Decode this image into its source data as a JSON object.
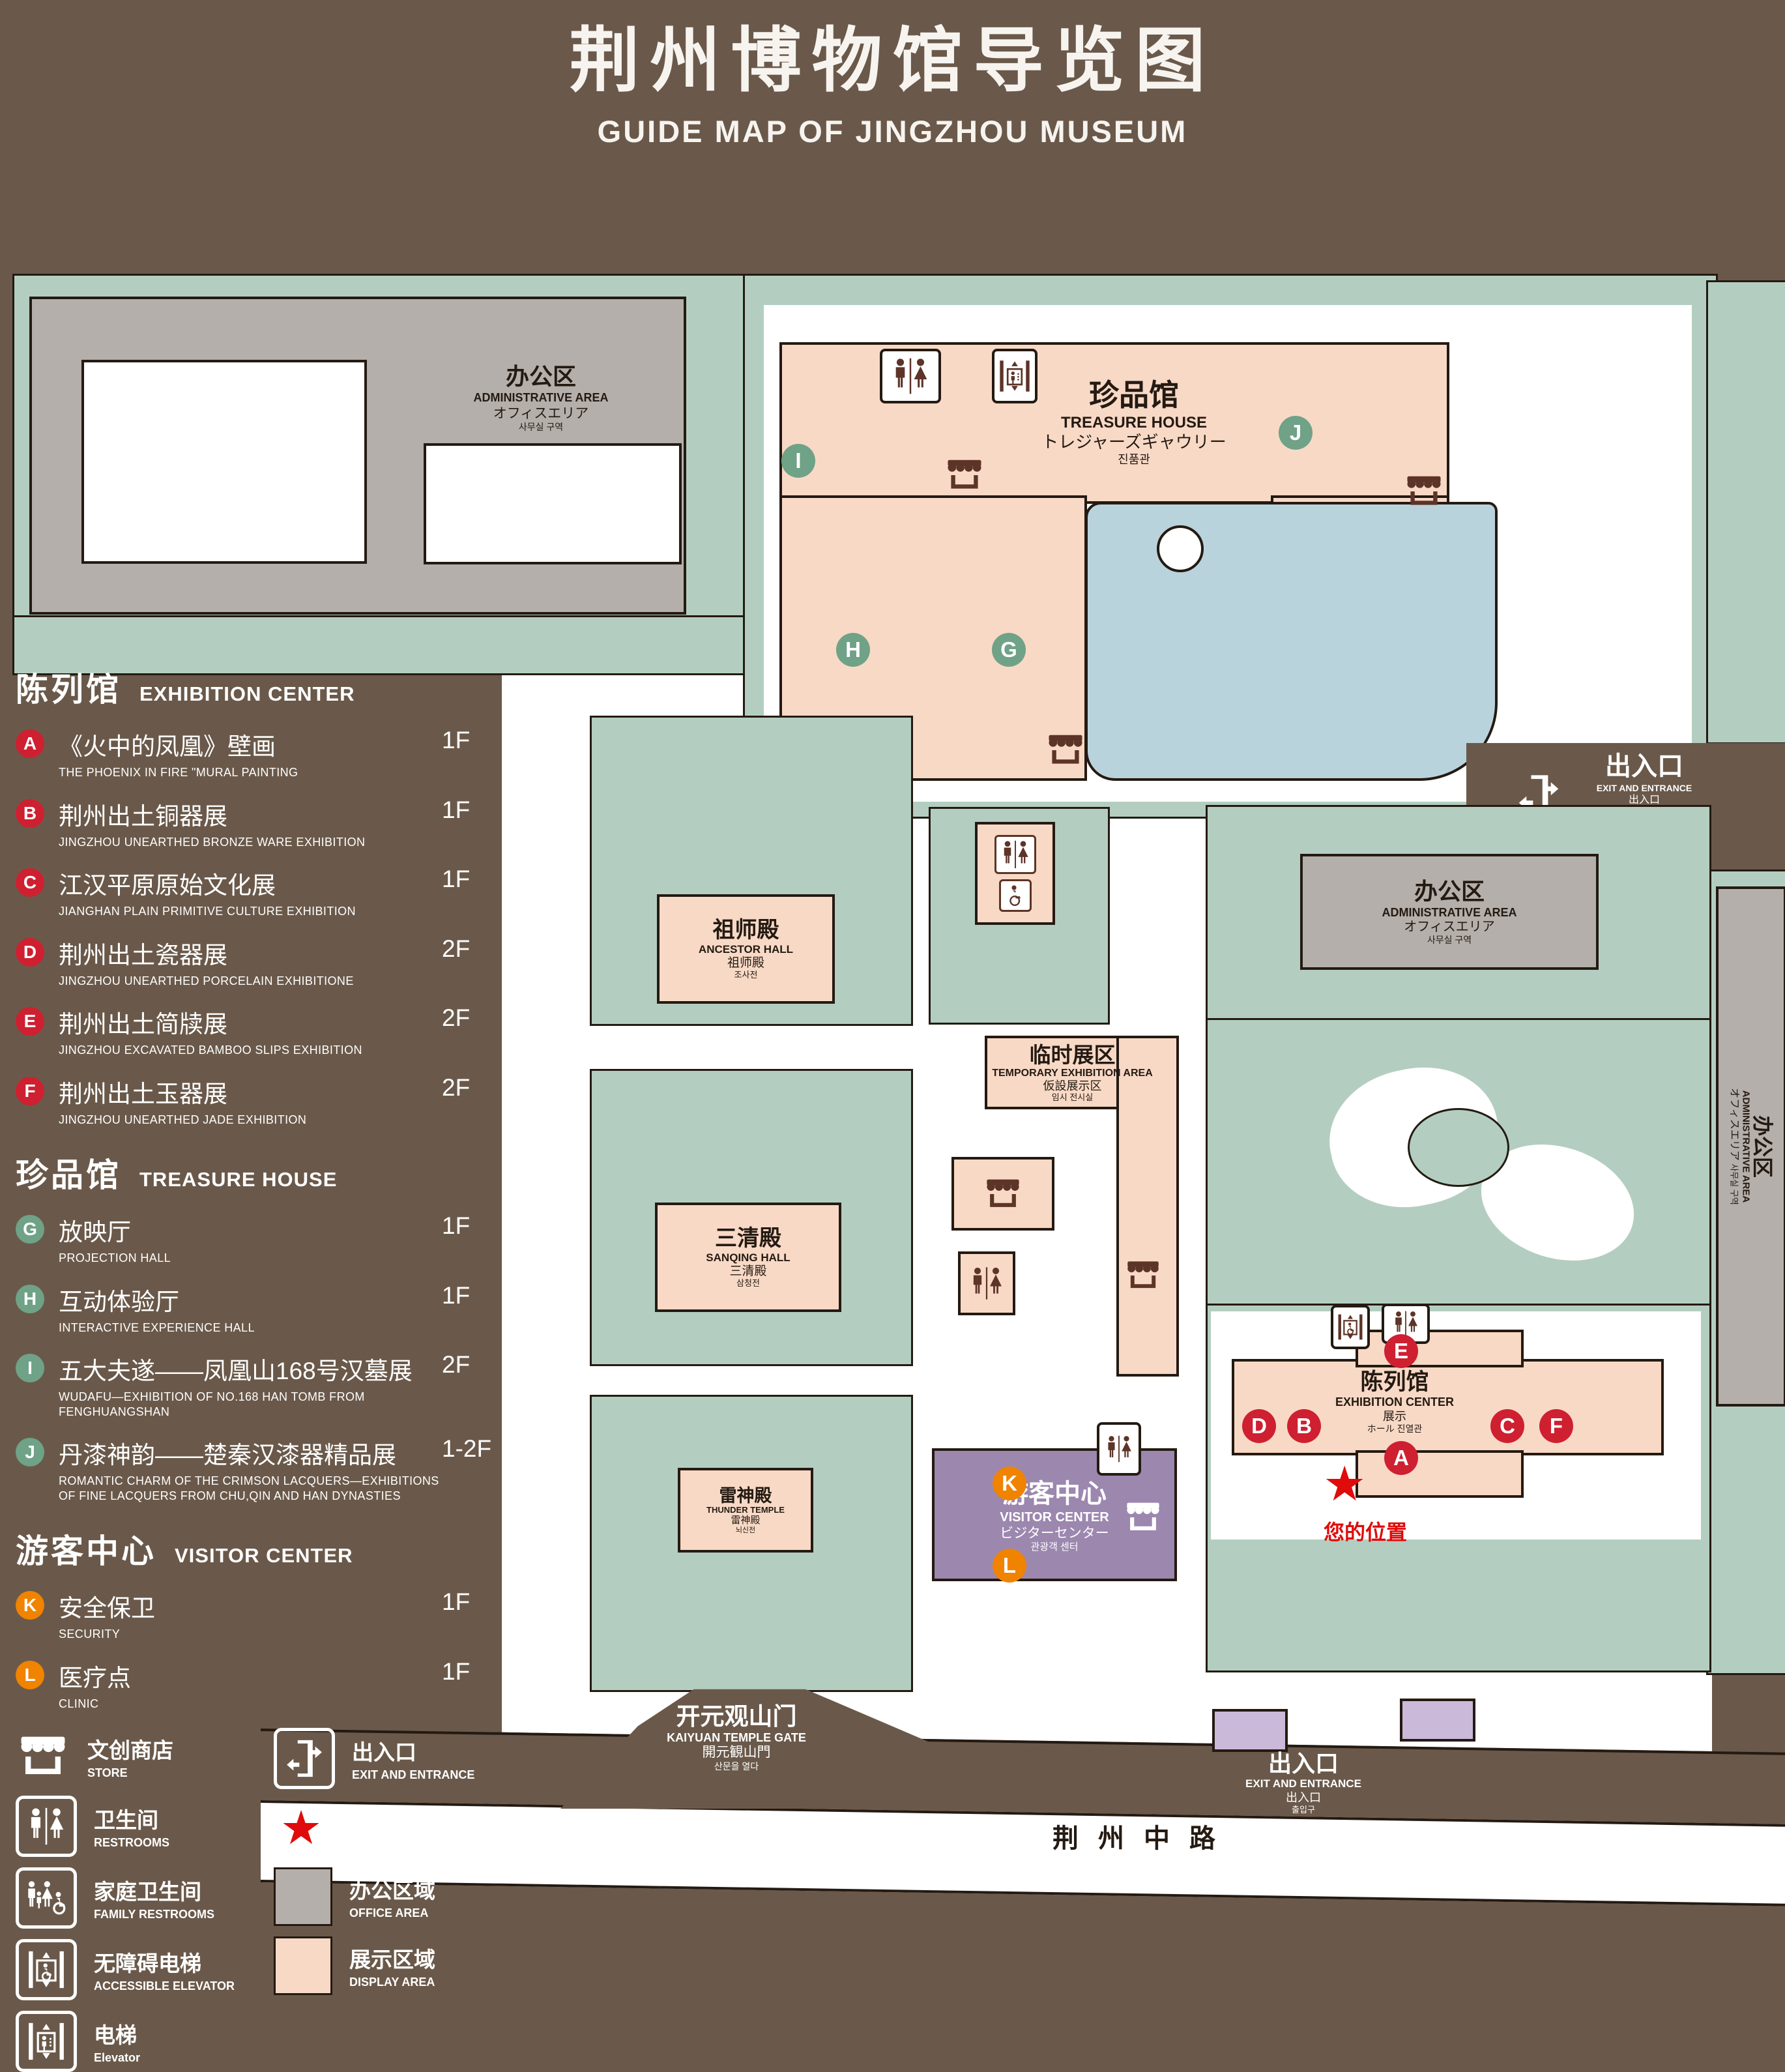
{
  "title": {
    "zh": "荆州博物馆导览图",
    "en": "GUIDE MAP OF JINGZHOU MUSEUM"
  },
  "legend": {
    "sections": [
      {
        "zh": "陈列馆",
        "en": "EXHIBITION CENTER",
        "items": [
          {
            "key": "A",
            "zh": "《火中的凤凰》壁画",
            "en": "THE PHOENIX IN FIRE \"MURAL PAINTING",
            "floor": "1F"
          },
          {
            "key": "B",
            "zh": "荆州出土铜器展",
            "en": "JINGZHOU UNEARTHED BRONZE WARE EXHIBITION",
            "floor": "1F"
          },
          {
            "key": "C",
            "zh": "江汉平原原始文化展",
            "en": "JIANGHAN PLAIN PRIMITIVE CULTURE EXHIBITION",
            "floor": "1F"
          },
          {
            "key": "D",
            "zh": "荆州出土瓷器展",
            "en": "JINGZHOU UNEARTHED PORCELAIN EXHIBITIONE",
            "floor": "2F"
          },
          {
            "key": "E",
            "zh": "荆州出土简牍展",
            "en": "JINGZHOU EXCAVATED BAMBOO SLIPS EXHIBITION",
            "floor": "2F"
          },
          {
            "key": "F",
            "zh": "荆州出土玉器展",
            "en": "JINGZHOU UNEARTHED JADE EXHIBITION",
            "floor": "2F"
          }
        ]
      },
      {
        "zh": "珍品馆",
        "en": "TREASURE HOUSE",
        "items": [
          {
            "key": "G",
            "zh": "放映厅",
            "en": "PROJECTION HALL",
            "floor": "1F"
          },
          {
            "key": "H",
            "zh": "互动体验厅",
            "en": "INTERACTIVE EXPERIENCE HALL",
            "floor": "1F"
          },
          {
            "key": "I",
            "zh": "五大夫遂——凤凰山168号汉墓展",
            "en": "WUDAFU—EXHIBITION OF NO.168 HAN TOMB FROM FENGHUANGSHAN",
            "floor": "2F"
          },
          {
            "key": "J",
            "zh": "丹漆神韵——楚秦汉漆器精品展",
            "en": "ROMANTIC CHARM OF THE CRIMSON LACQUERS—EXHIBITIONS OF FINE LACQUERS FROM CHU,QIN AND HAN DYNASTIES",
            "floor": "1-2F"
          }
        ]
      },
      {
        "zh": "游客中心",
        "en": "VISITOR CENTER",
        "items": [
          {
            "key": "K",
            "zh": "安全保卫",
            "en": "SECURITY",
            "floor": "1F"
          },
          {
            "key": "L",
            "zh": "医疗点",
            "en": "CLINIC",
            "floor": "1F"
          }
        ]
      }
    ],
    "symbols_left": [
      {
        "zh": "文创商店",
        "en": "STORE"
      },
      {
        "zh": "卫生间",
        "en": "RESTROOMS"
      },
      {
        "zh": "家庭卫生间",
        "en": "FAMILY RESTROOMS"
      },
      {
        "zh": "无障碍电梯",
        "en": "ACCESSIBLE ELEVATOR"
      },
      {
        "zh": "电梯",
        "en": "Elevator"
      }
    ],
    "symbols_right": [
      {
        "zh": "出入口",
        "en": "EXIT AND ENTRANCE"
      },
      {
        "zh": "您的位置",
        "en": "YOUR LOCATION"
      },
      {
        "zh": "办公区域",
        "en": "OFFICE AREA"
      },
      {
        "zh": "展示区域",
        "en": "DISPLAY AREA"
      }
    ]
  },
  "map": {
    "admin_nw": {
      "zh": "办公区",
      "en": "ADMINISTRATIVE AREA",
      "ja": "オフィスエリア",
      "ko": "사무실 구역"
    },
    "treasure": {
      "zh": "珍品馆",
      "en": "TREASURE HOUSE",
      "ja": "トレジャーズギャウリー",
      "ko": "진품관"
    },
    "exit_ne": {
      "zh": "出入口",
      "en": "EXIT AND ENTRANCE",
      "ja": "出入口",
      "ko": "출입구"
    },
    "admin_e": {
      "zh": "办公区",
      "en": "ADMINISTRATIVE AREA",
      "ja": "オフィスエリア",
      "ko": "사무실 구역"
    },
    "admin_far_e": {
      "zh": "办公区",
      "en": "ADMINISTRATIVE AREA",
      "ja": "オフィスエリア",
      "ko": "사무실 구역"
    },
    "ancestor": {
      "zh": "祖师殿",
      "en": "ANCESTOR HALL",
      "ja": "祖师殿",
      "ko": "조사전"
    },
    "temporary": {
      "zh": "临时展区",
      "en": "TEMPORARY EXHIBITION AREA",
      "ja": "仮設展示区",
      "ko": "임시 전시실"
    },
    "sanqing": {
      "zh": "三清殿",
      "en": "SANQING HALL",
      "ja": "三清殿",
      "ko": "삼청전"
    },
    "thunder": {
      "zh": "雷神殿",
      "en": "THUNDER TEMPLE",
      "ja": "雷神殿",
      "ko": "뇌신전"
    },
    "visitor": {
      "zh": "游客中心",
      "en": "VISITOR CENTER",
      "ja": "ビジターセンター",
      "ko": "관광객 센터"
    },
    "exhibition": {
      "zh": "陈列馆",
      "en": "EXHIBITION CENTER",
      "ja": "展示",
      "ko": "ホール 진열관"
    },
    "gate": {
      "zh": "开元观山门",
      "en": "KAIYUAN TEMPLE GATE",
      "ja": "開元観山門",
      "ko": "산문을 열다"
    },
    "exit_s": {
      "zh": "出入口",
      "en": "EXIT AND ENTRANCE",
      "ja": "出入口",
      "ko": "출입구"
    },
    "road": {
      "zh": "荆州中路"
    },
    "your_location": {
      "zh": "您的位置"
    },
    "markers": {
      "A": "A",
      "B": "B",
      "C": "C",
      "D": "D",
      "E": "E",
      "F": "F",
      "G": "G",
      "H": "H",
      "I": "I",
      "J": "J",
      "K": "K",
      "L": "L"
    },
    "star": "★"
  },
  "colors": {
    "bg": "#6a594a",
    "ground": "#b3cec0",
    "display": "#f8d9c6",
    "office": "#b4afab",
    "water": "#b9d3dc",
    "visitor": "#9c87af",
    "pad": "#cbb9d9",
    "badge_red": "#ce2030",
    "badge_green": "#6fa287",
    "badge_orange": "#f08300",
    "location_red": "#e00b0b"
  }
}
